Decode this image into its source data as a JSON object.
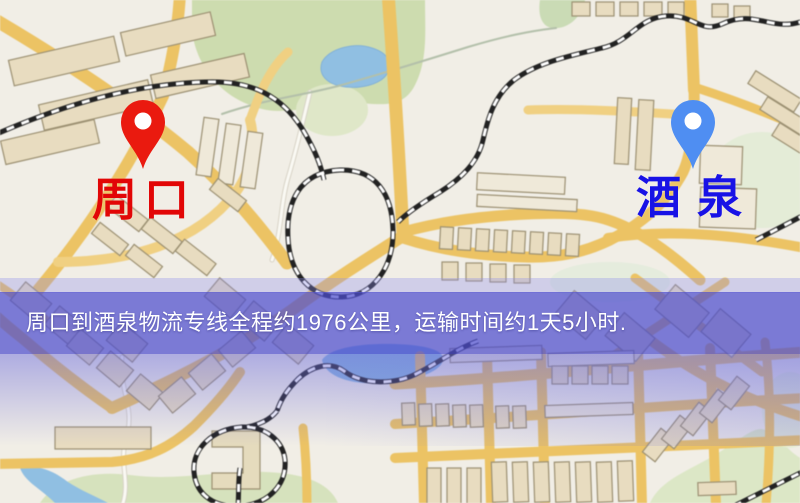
{
  "markers": {
    "origin": {
      "label": "周口",
      "pin_color": "#ea1a0f",
      "label_color": "#e20606"
    },
    "destination": {
      "label": "酒泉",
      "pin_color": "#4f8ef2",
      "label_color": "#1812e6"
    }
  },
  "banner": {
    "text": "周口到酒泉物流专线全程约1976公里，运输时间约1天5小时.",
    "bg_color": "#4e4ece",
    "text_color": "#ffffff"
  },
  "route": {
    "origin": "周口",
    "destination": "酒泉",
    "distance": "约1976公里",
    "duration": "约1天5小时"
  },
  "map_palette": {
    "background": "#f2efe6",
    "road": "#f0c35a",
    "road_minor": "#f5d584",
    "park": "#cdddab",
    "water": "#8cc0e6",
    "building": "#eaddbd",
    "railway": "#1f1f1f"
  }
}
